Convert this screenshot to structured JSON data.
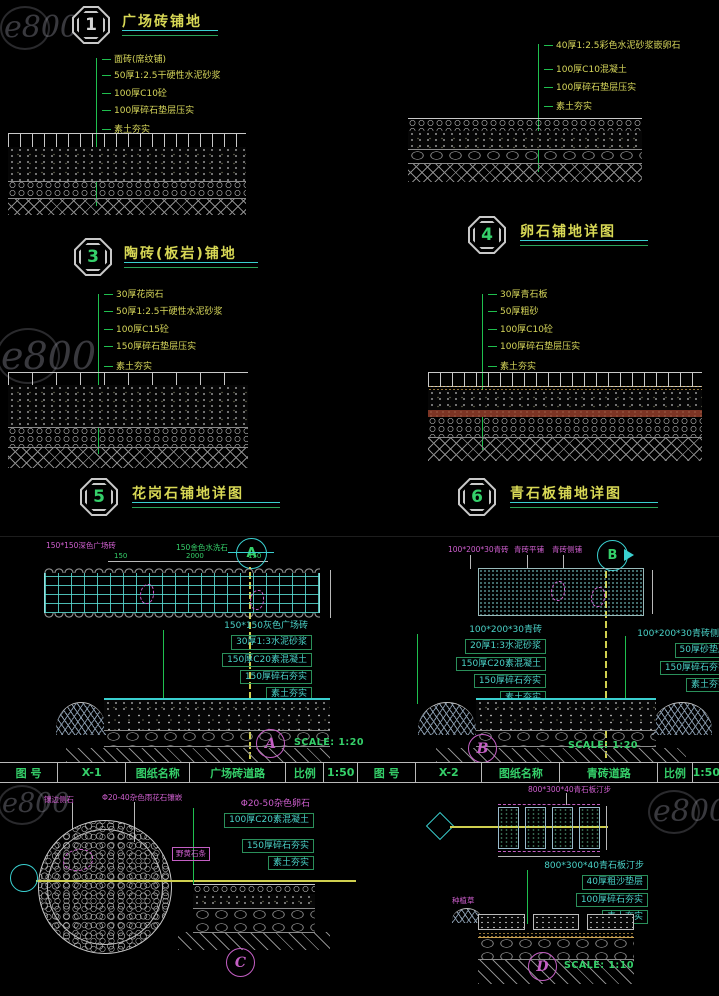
{
  "watermark_text": "e800",
  "top": {
    "d1": {
      "badge": "1",
      "title": "广场砖铺地",
      "notes": [
        "面砖(席纹铺)",
        "50厚1:2.5干硬性水泥砂浆",
        "100厚C10砼",
        "100厚碎石垫层压实",
        "素土夯实"
      ]
    },
    "d4": {
      "badge": "4",
      "title": "卵石铺地详图",
      "notes": [
        "40厚1:2.5彩色水泥砂浆嵌卵石",
        "100厚C10混凝土",
        "100厚碎石垫层压实",
        "素土夯实"
      ]
    },
    "d3": {
      "badge": "3",
      "title": "陶砖(板岩)铺地"
    },
    "d5": {
      "badge": "5",
      "title": "花岗石铺地详图",
      "notes": [
        "30厚花岗石",
        "50厚1:2.5干硬性水泥砂浆",
        "100厚C15砼",
        "150厚碎石垫层压实",
        "素土夯实"
      ]
    },
    "d6": {
      "badge": "6",
      "title": "青石板铺地详图",
      "notes": [
        "30厚青石板",
        "50厚粗砂",
        "100厚C10砼",
        "100厚碎石垫层压实",
        "素土夯实"
      ]
    }
  },
  "middle": {
    "a": {
      "bubble": "A",
      "label_dark_tile": "150*150深色广场砖",
      "label_gold_stone": "150金色水洗石",
      "dims": [
        "150",
        "2000",
        "150"
      ],
      "notes": [
        "150*150灰色广场砖",
        "30厚1:3水泥砂浆",
        "150厚C20素混凝土",
        "150厚碎石夯实",
        "素土夯实"
      ],
      "scale": "SCALE: 1:20"
    },
    "b": {
      "bubble": "B",
      "label_brick": "100*200*30青砖",
      "label_flat": "青砖平铺",
      "label_side": "青砖侧铺",
      "notes_main": [
        "100*200*30青砖",
        "20厚1:3水泥砂浆",
        "150厚C20素混凝土",
        "150厚碎石夯实",
        "素土夯实"
      ],
      "notes_side": [
        "100*200*30青砖侧铺",
        "50厚砂垫层",
        "150厚碎石夯实",
        "素土夯实"
      ],
      "scale": "SCALE: 1:20"
    },
    "titleblock_left": {
      "cells": [
        "图 号",
        "X-1",
        "图纸名称",
        "广场砖道路",
        "比例",
        "1:50"
      ]
    },
    "titleblock_right": {
      "cells": [
        "图 号",
        "X-2",
        "图纸名称",
        "青砖道路",
        "比例",
        "1:50"
      ]
    }
  },
  "bottom": {
    "c": {
      "bubble": "C",
      "label_edge": "镶边侧石",
      "label_mosaic": "Φ20-40杂色雨花石镶嵌",
      "label_stone": "野黄石条",
      "notes": [
        "Φ20-50杂色卵石",
        "100厚C20素混凝土",
        "150厚碎石夯实",
        "素土夯实"
      ]
    },
    "d": {
      "bubble": "D",
      "label_top": "800*300*40青石板汀步",
      "label_grass": "种植草",
      "notes": [
        "800*300*40青石板汀步",
        "40厚粗沙垫层",
        "100厚碎石夯实",
        "素土夯实"
      ],
      "scale": "SCALE: 1:10"
    }
  }
}
